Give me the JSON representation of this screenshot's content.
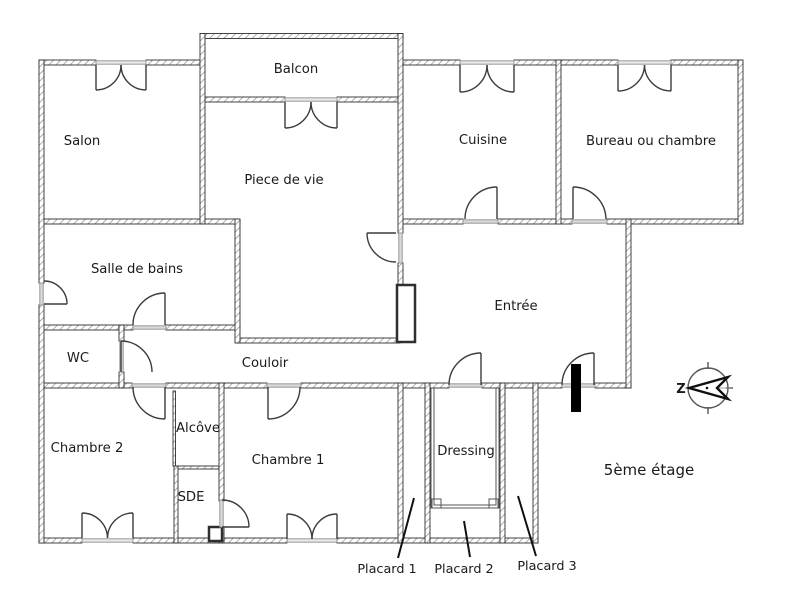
{
  "fp": {
    "floor_label": "5ème étage",
    "compass_letter": "Z",
    "rooms": {
      "salon": "Salon",
      "balcon": "Balcon",
      "piece_de_vie": "Piece de vie",
      "cuisine": "Cuisine",
      "bureau": "Bureau ou chambre",
      "salle_de_bains": "Salle de bains",
      "entree": "Entrée",
      "wc": "WC",
      "couloir": "Couloir",
      "chambre2": "Chambre 2",
      "alcove": "Alcôve",
      "sde": "SDE",
      "chambre1": "Chambre 1",
      "dressing": "Dressing",
      "placard1": "Placard 1",
      "placard2": "Placard 2",
      "placard3": "Placard 3"
    },
    "colors": {
      "wall_outline": "#2f2f2f",
      "wall_hatch": "#9a9a9a",
      "door_line": "#3c3c3c",
      "sill": "#999999",
      "opening_fill": "#d9d9d9",
      "label": "#1a1a1a",
      "entry_marker": "#000000"
    }
  }
}
